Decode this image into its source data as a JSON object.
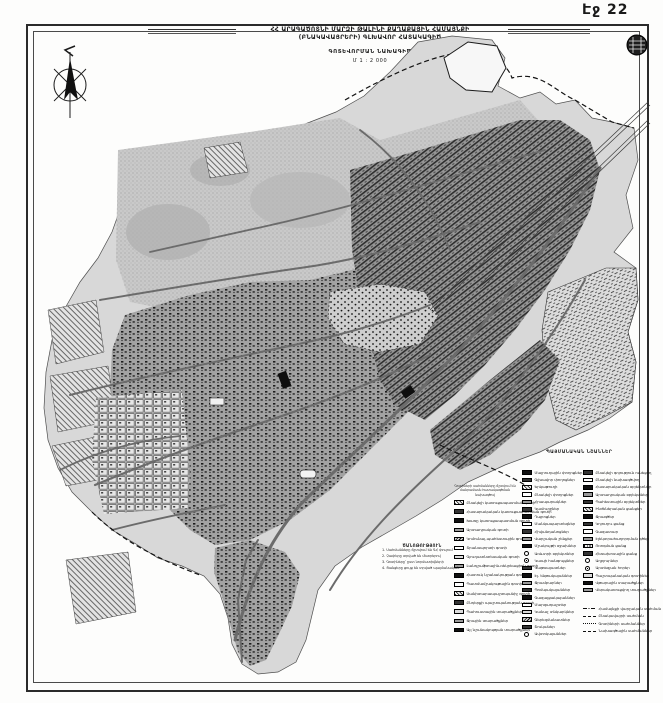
{
  "page": {
    "label": "Էջ 22"
  },
  "title": {
    "line1": "ՀՀ ԱՐԱԳԱԾՈՏՆԻ ՄԱՐԶԻ ԹԱԼԻՆԻ ՔԱՂԱՔԱՅԻՆ ՀԱՄԱՅՆՔԻ",
    "line2": "(ԲՆԱԿԱՎԱՅՐԵՐԻ) ԳԼԽԱՎՈՐ ՀԱՏԱԿԱԳԻԾ",
    "subtitle": "ԳՈՏԵՎՈՐՄԱՆ ՆԱԽԱԳԻԾ",
    "scale": "Մ 1 : 2 000"
  },
  "colors": {
    "paper": "#fdfdfc",
    "ink": "#1a1a1a",
    "map_light": "#d8d8d8",
    "map_mid": "#a2a2a2",
    "map_dark": "#6b6b6b"
  },
  "icons": {
    "compass": "compass-rose",
    "seal": "round-seal"
  },
  "legend": {
    "title": "ՊԱՅՄԱՆԱԿԱՆ ՆՇԱՆՆԵՐ",
    "note_lines": [
      "Գոտիների սահմանները ճշտվում են",
      "մանրամասն հատակագծման նախագծով"
    ],
    "col1": [
      {
        "sw": "sw-hatch",
        "label": "Բնակելի կառուցապատման գոտի"
      },
      {
        "sw": "sw-dark",
        "label": "Հասարակական կառուցապատման գոտի"
      },
      {
        "sw": "sw-solid",
        "label": "Խառը կառուցապատման գոտի"
      },
      {
        "sw": "sw-gray",
        "label": "Արտադրական գոտի"
      },
      {
        "sw": "sw-hatch2",
        "label": "Կոմունալ-պահեստային գոտի"
      },
      {
        "sw": "sw-outline",
        "label": "Տրանսպորտի գոտի"
      },
      {
        "sw": "sw-light",
        "label": "Գյուղատնտեսական գոտի"
      },
      {
        "sw": "sw-gray",
        "label": "Լանդշաֆտային-ռեկրեացիոն գոտի"
      },
      {
        "sw": "sw-solid",
        "label": "Հատուկ նշանակության գոտի"
      },
      {
        "sw": "sw-outline",
        "label": "Պատմամշակութային գոտի"
      },
      {
        "sw": "sw-hatch",
        "label": "Սանիտարապաշտպանիչ գոտի"
      },
      {
        "sw": "sw-dark",
        "label": "Ընդերքի պաշտպանության գոտի"
      },
      {
        "sw": "sw-light",
        "label": "Պահուստային տարածքներ"
      },
      {
        "sw": "sw-gray",
        "label": "Ջրային տարածքներ"
      },
      {
        "sw": "sw-solid",
        "label": "Այլ նշանակության տարածքներ"
      }
    ],
    "col2": [
      {
        "sw": "sw-solid",
        "label": "Մայրուղային փողոցներ"
      },
      {
        "sw": "sw-dark",
        "label": "Գլխավոր փողոցներ"
      },
      {
        "sw": "sw-hatch",
        "label": "Երկաթուղի"
      },
      {
        "sw": "sw-outline",
        "label": "Բնակելի փողոցներ"
      },
      {
        "sw": "sw-gray",
        "label": "Հրապարակներ"
      },
      {
        "sw": "sw-dark",
        "label": "Կամուրջներ"
      },
      {
        "sw": "sw-solid",
        "label": "Դպրոցներ"
      },
      {
        "sw": "sw-outline",
        "label": "Մանկապարտեզներ"
      },
      {
        "sw": "sw-dark",
        "label": "Հիվանդանոցներ"
      },
      {
        "sw": "sw-gray",
        "label": "Վարչական շենքեր"
      },
      {
        "sw": "sw-solid",
        "label": "Մշակույթի օջախներ"
      },
      {
        "sw": "sw-circle",
        "label": "Առևտրի օբյեկտներ"
      },
      {
        "sw": "sw-target",
        "label": "Կապի հանգույցներ"
      },
      {
        "sw": "sw-dark",
        "label": "Կաթսայատներ"
      },
      {
        "sw": "sw-solid",
        "label": "Էլ. ենթակայաններ"
      },
      {
        "sw": "sw-gray",
        "label": "Ջրամբարներ"
      },
      {
        "sw": "sw-dark",
        "label": "Պոմպակայաններ"
      },
      {
        "sw": "sw-solid",
        "label": "Գազալցակայաններ"
      },
      {
        "sw": "sw-outline",
        "label": "Մարզադաշտեր"
      },
      {
        "sw": "sw-light",
        "label": "Կանաչ տնկարկներ"
      },
      {
        "sw": "sw-hatch2",
        "label": "Գերեզմանատներ"
      },
      {
        "sw": "sw-dark",
        "label": "Շուկաներ"
      },
      {
        "sw": "sw-circle",
        "label": "Ավտոկայաններ"
      }
    ],
    "col3": [
      {
        "sw": "sw-dark",
        "label": "Բնակելի գոյություն ունեցող"
      },
      {
        "sw": "sw-outline",
        "label": "Բնակելի նախագծվող"
      },
      {
        "sw": "sw-solid",
        "label": "Հասարակական օբյեկտներ"
      },
      {
        "sw": "sw-gray",
        "label": "Արտադրական օբյեկտներ"
      },
      {
        "sw": "sw-dark",
        "label": "Պահեստային օբյեկտներ"
      },
      {
        "sw": "sw-hatch",
        "label": "Ինժեներական ցանցեր"
      },
      {
        "sw": "sw-solid",
        "label": "Ջրագծեր"
      },
      {
        "sw": "sw-dark",
        "label": "Կոյուղու ցանց"
      },
      {
        "sw": "sw-outline",
        "label": "Գազատար"
      },
      {
        "sw": "sw-gray",
        "label": "Էլեկտրահաղորդման գծեր"
      },
      {
        "sw": "sw-vlines",
        "label": "Ոռոգման ցանց"
      },
      {
        "sw": "sw-dark",
        "label": "Հեռախոսային ցանց"
      },
      {
        "sw": "sw-circle",
        "label": "Աղբյուրներ"
      },
      {
        "sw": "sw-target",
        "label": "Արտեզյան հորեր"
      },
      {
        "sw": "sw-light",
        "label": "Պաշտպանական գոտիներ"
      },
      {
        "sw": "sw-solid",
        "label": "Վթարային տարածքներ"
      },
      {
        "sw": "sw-gray",
        "label": "Վերակառուցվող տարածքներ"
      }
    ],
    "lines": [
      {
        "sw": "sw-dashdot",
        "label": "Համայնքի վարչական սահման"
      },
      {
        "sw": "sw-dash",
        "label": "Բնակավայրի սահման"
      },
      {
        "sw": "sw-dashfine",
        "label": "Գոտիների սահմաններ"
      },
      {
        "sw": "sw-dash",
        "label": "Նախագծային սահմաններ"
      }
    ]
  },
  "notes": {
    "heading": "ԾԱՆՈԹՈՒԹՅՈՒՆ",
    "items": [
      "1. Սահմանները ճշտվում են ԳՀ փուլում",
      "2. Չափերը տրված են մետրերով",
      "3. Գոտիները՝ ըստ նորմատիվների",
      "4. Ցանցերը ցույց են տրված պայմանական"
    ]
  }
}
